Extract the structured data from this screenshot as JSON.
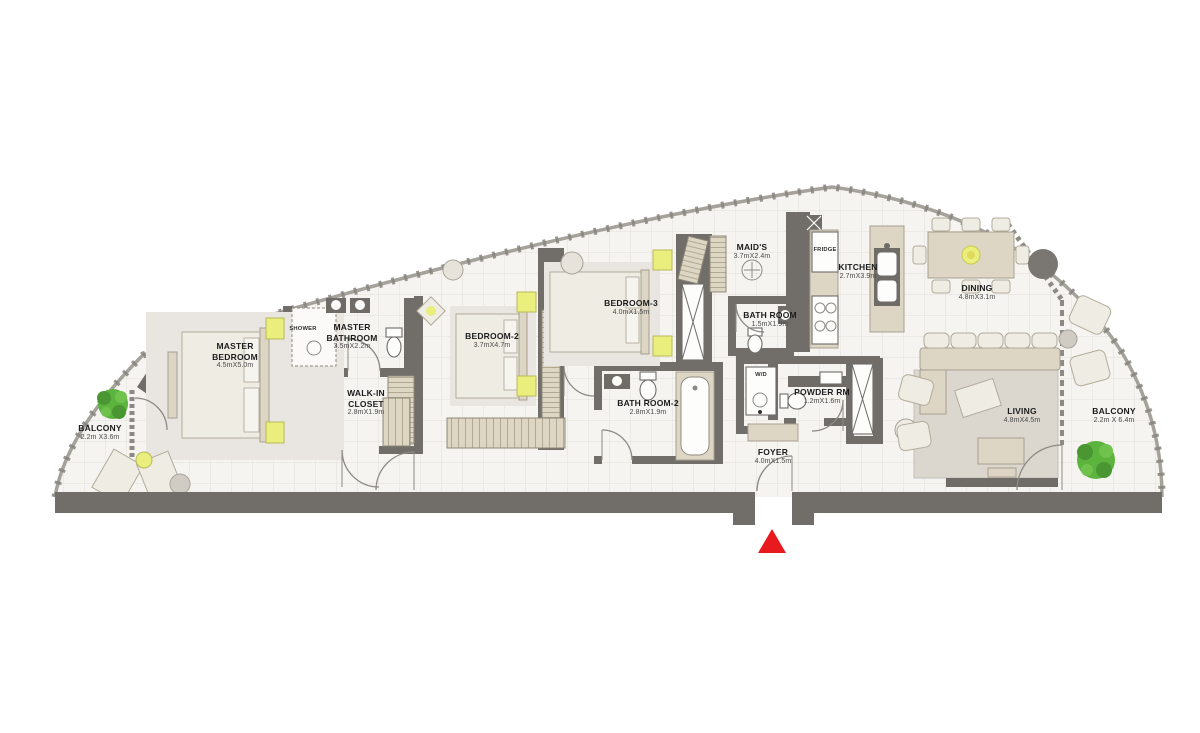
{
  "plan": {
    "title": "Apartment floor plan",
    "rooms": {
      "master_bedroom": {
        "name": "MASTER BEDROOM",
        "dims": "4.5mX5.0m"
      },
      "master_bathroom": {
        "name": "MASTER BATHROOM",
        "dims": "3.5mX2.2m"
      },
      "shower": {
        "name": "SHOWER"
      },
      "walk_in_closet": {
        "name": "WALK-IN CLOSET",
        "dims": "2.8mX1.9m"
      },
      "bedroom_2": {
        "name": "BEDROOM-2",
        "dims": "3.7mX4.7m"
      },
      "bedroom_3": {
        "name": "BEDROOM-3",
        "dims": "4.0mX1.5m"
      },
      "bath_room_2": {
        "name": "BATH ROOM-2",
        "dims": "2.8mX1.9m"
      },
      "maids": {
        "name": "MAID'S",
        "dims": "3.7mX2.4m"
      },
      "bath_room": {
        "name": "BATH ROOM",
        "dims": "1.5mX1.9m"
      },
      "kitchen": {
        "name": "KITCHEN",
        "dims": "2.7mX3.9m"
      },
      "fridge": {
        "name": "FRIDGE"
      },
      "wd": {
        "name": "W/D"
      },
      "powder_rm": {
        "name": "POWDER RM",
        "dims": "1.2mX1.6m"
      },
      "foyer": {
        "name": "FOYER",
        "dims": "4.0mX1.5m"
      },
      "dining": {
        "name": "DINING",
        "dims": "4.8mX3.1m"
      },
      "living": {
        "name": "LIVING",
        "dims": "4.8mX4.5m"
      },
      "balcony_left": {
        "name": "BALCONY",
        "dims": "2.2m X3.6m"
      },
      "balcony_right": {
        "name": "BALCONY",
        "dims": "2.2m X 6.4m"
      }
    },
    "colors": {
      "wall": "#716e6a",
      "wall_light": "#8d8a84",
      "floor": "#f5f4f1",
      "grid": "#e3e0d9",
      "furniture": "#ddd6c4",
      "furniture_light": "#efece4",
      "accent_yellow": "#e9ee7d",
      "tree_green": "#5cb43e",
      "entrance_red": "#e8191f",
      "planter_gray": "#7a7772",
      "text_dark": "#1c1c1c"
    }
  }
}
